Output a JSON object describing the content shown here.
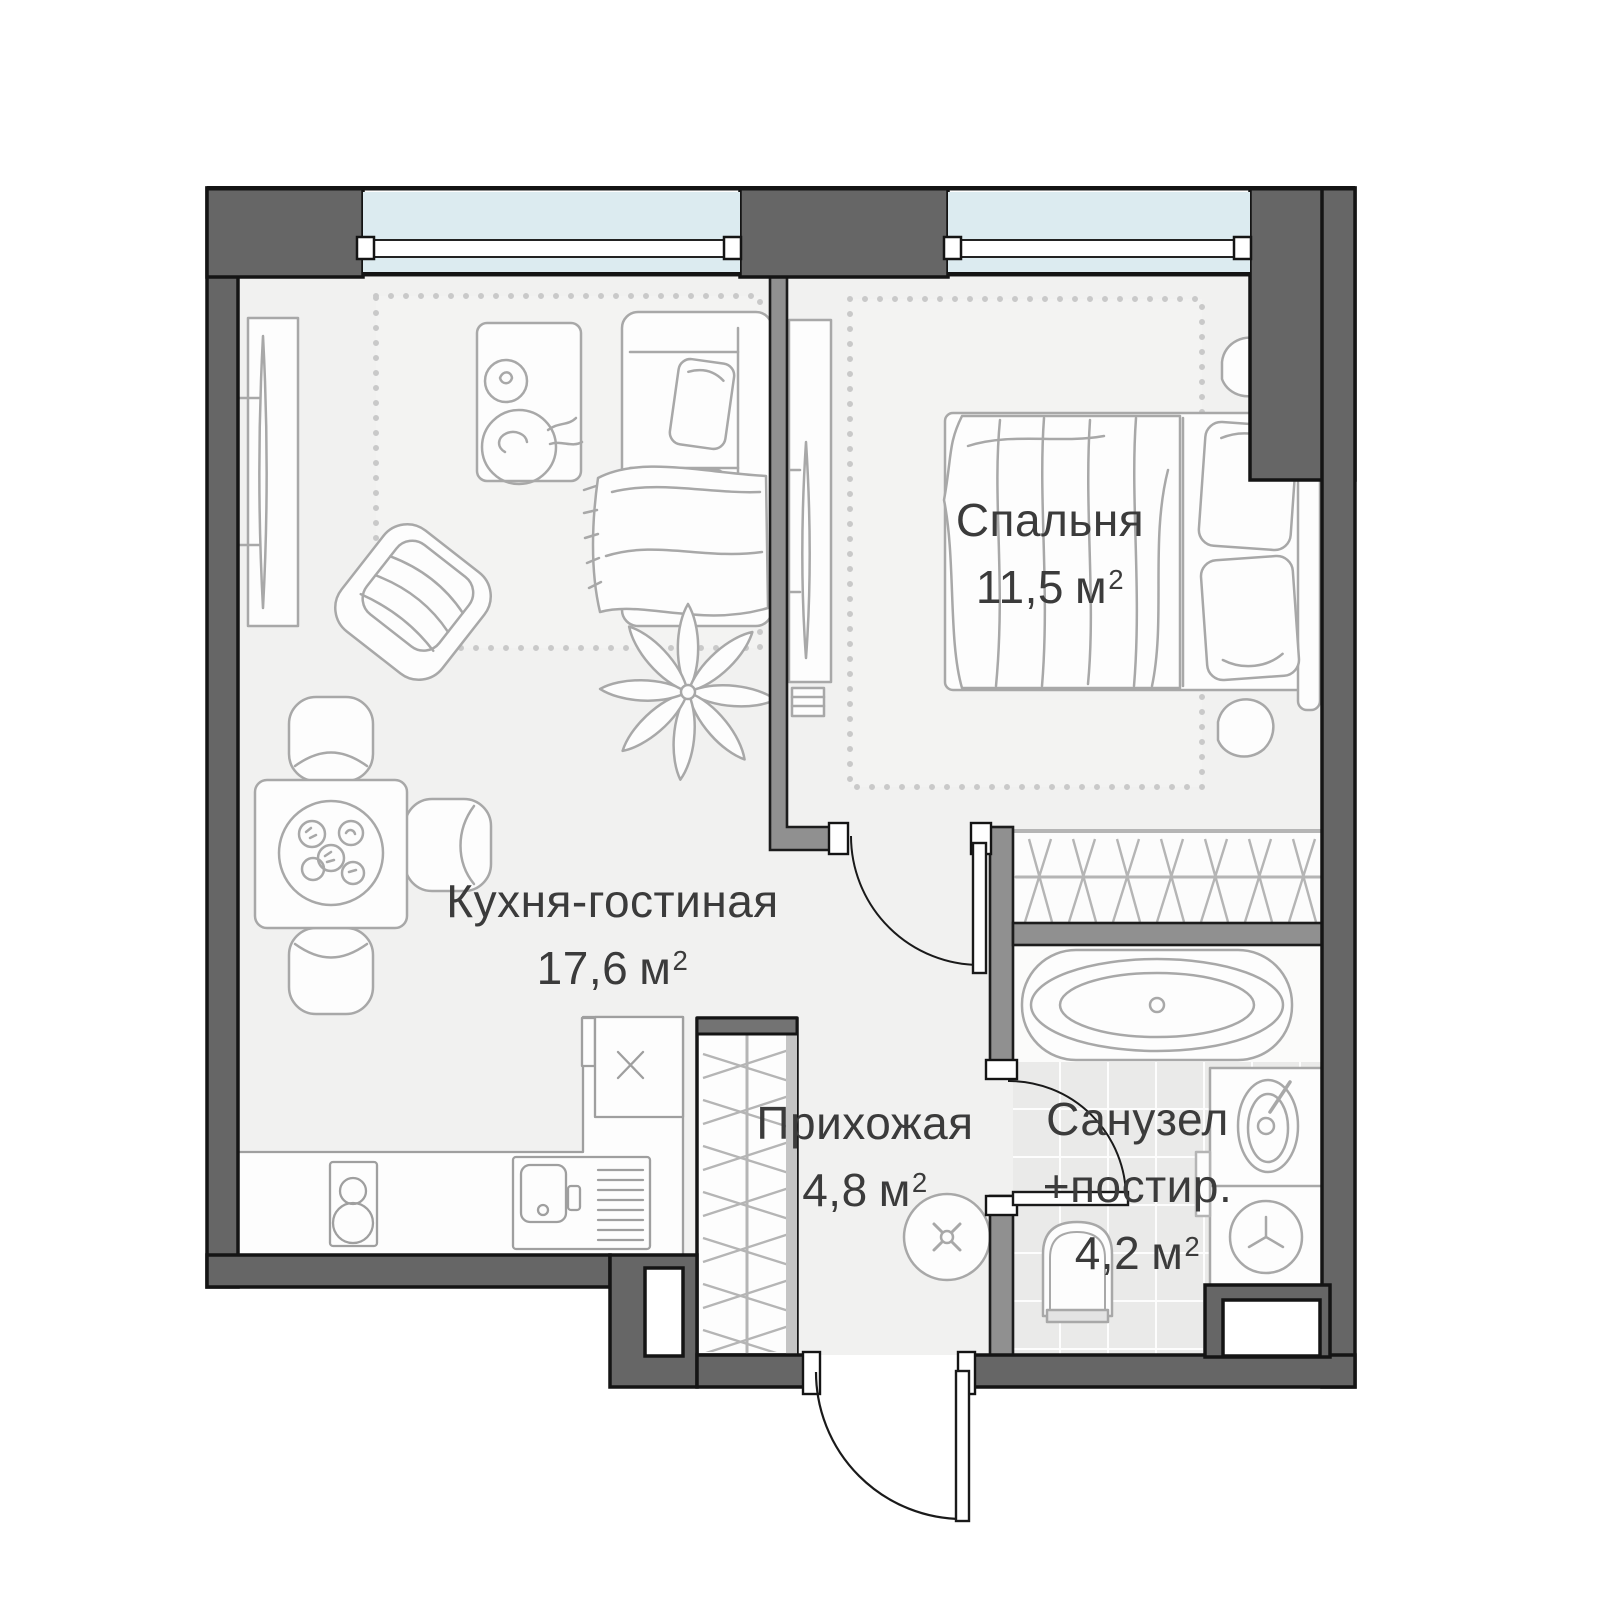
{
  "meta": {
    "title": "Apartment floor plan",
    "area_superscript": "2",
    "palette": {
      "outer_wall": "#666666",
      "partition_wall": "#909090",
      "window_glass": "#dcebf0",
      "floor": "#f1f1f0",
      "bath_tile": "#eaeae9",
      "furniture_line": "#a8a8a8",
      "closet_line": "#b5b5b5",
      "text": "#3b3b3b"
    }
  },
  "rooms": [
    {
      "id": "bedroom",
      "name": "Спальня",
      "area": "11,5",
      "unit": "м"
    },
    {
      "id": "kitchen-living",
      "name": "Кухня-гостиная",
      "area": "17,6",
      "unit": "м"
    },
    {
      "id": "hallway",
      "name": "Прихожая",
      "area": "4,8",
      "unit": "м"
    },
    {
      "id": "bathroom",
      "name": "Санузел",
      "name2": "+постир.",
      "area": "4,2",
      "unit": "м"
    }
  ]
}
